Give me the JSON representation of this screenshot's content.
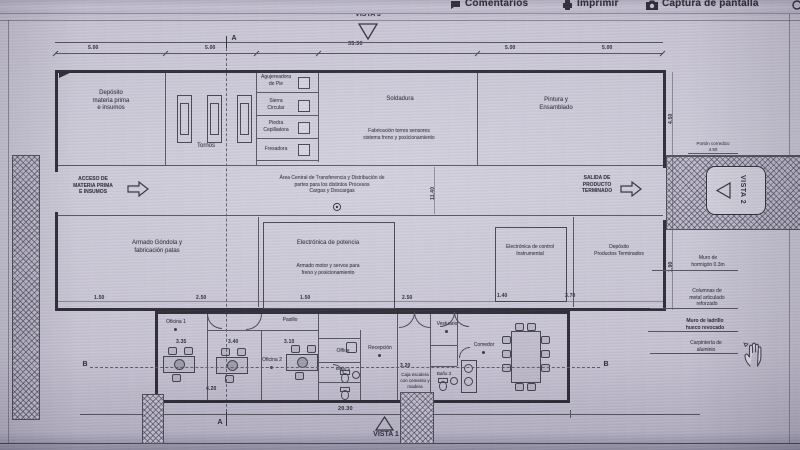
{
  "toolbar": {
    "comments": "Comentarios",
    "print": "Imprimir",
    "screenshot": "Captura de pantalla"
  },
  "views": {
    "v1": "VISTA 1",
    "v2": "VISTA 2",
    "v3": "VISTA 3"
  },
  "sections": {
    "a": "A",
    "b": "B"
  },
  "rooms": {
    "deposito_mp": "Depósito\nmateria prima\ne insumos",
    "tornos": "Tornos",
    "soldadura": "Soldadura",
    "soldadura_sub": "Fabricación torres sensores\nsistema freno y posicionamiento",
    "pintura": "Pintura y\nEnsamblado",
    "armado_gondola": "Armado Góndola y\nfabricación patas",
    "elec_potencia": "Electrónica de potencia",
    "armado_motor": "Armado motor y servos para\nfreno y posicionamiento",
    "elec_control": "Electrónica de control\nInstrumental",
    "deposito_pt": "Depósito\nProductos Terminados",
    "oficina1": "Oficina 1",
    "oficina2": "Oficina 2",
    "pasillo": "Pasillo",
    "office": "Office",
    "recepcion": "Recepción",
    "banio1": "Baño 1",
    "banio3": "Baño 3",
    "vestuario": "Vestuario",
    "comedor": "Comedor",
    "caja": "Caja escalera\ncon cemento y\nmadera"
  },
  "machines": [
    "Agujereadora\nde Pie",
    "Sierra\nCircular",
    "Piedra\nCepilladora",
    "Fresadora"
  ],
  "flows": {
    "acceso": "ACCESO DE\nMATERIA PRIMA\nE INSUMOS",
    "central": "Área Central de Transferencia y Distribución de\npartes para los distintos Procesos\nCargas y Descargas",
    "salida": "SALIDA DE\nPRODUCTO\nTERMINADO"
  },
  "callouts": {
    "porton": "Portón corredizo\n4.50",
    "muro_h": "Muro de\nhormigón 0.3m",
    "columnas": "Columnas de\nmetal articulado\nreforzado",
    "ladrillo": "Muro de ladrillo\nhueco revocado",
    "carpinteria": "Carpintería de\naluminio"
  },
  "dims": {
    "total_top": "35.30",
    "seg": "5.00",
    "v_center": "11.40",
    "right_top": "4.50",
    "right_mid": "1.90",
    "low1": "1.50",
    "low2": "2.50",
    "low3": "1.50",
    "low4": "2.50",
    "low5": "1.40",
    "low6": "3.70",
    "off1": "3.35",
    "off2": "3.40",
    "off3": "3.10",
    "off4": "4.20",
    "corridor": "3.20",
    "bottom_total": "20.30"
  },
  "colors": {
    "ink": "#2e2c3a",
    "wall": "#23222d",
    "paper": "#cfccda"
  }
}
